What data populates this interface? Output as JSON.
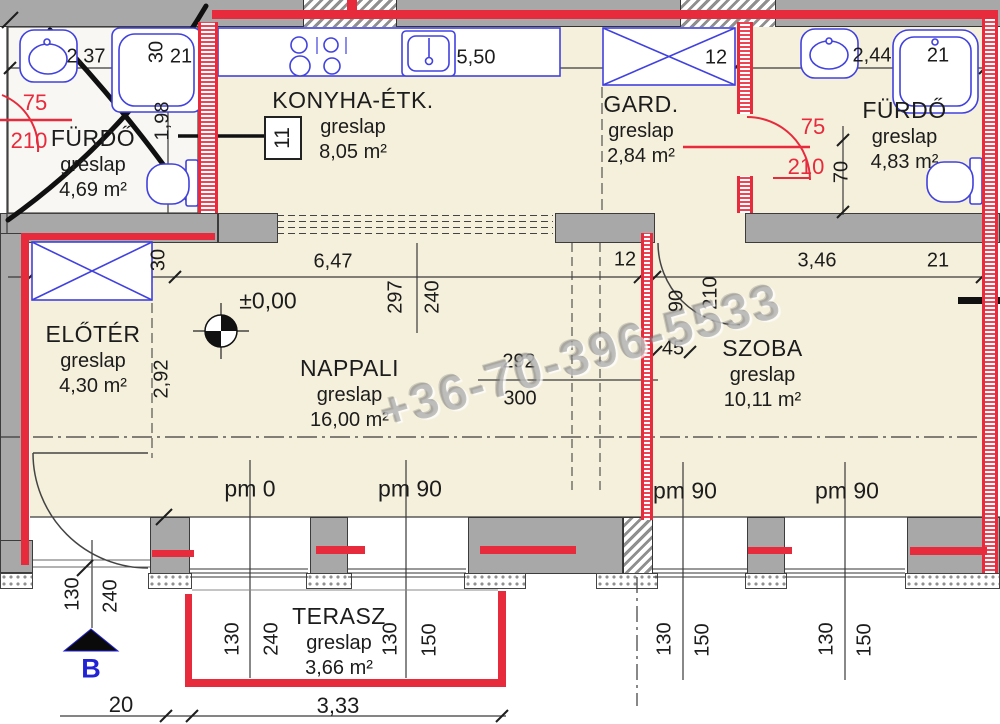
{
  "meta": {
    "watermark": "+36-70-396-5533",
    "room_tag": "11"
  },
  "colors": {
    "wall_gray": "#a8a8a8",
    "floor_cream": "#f5f0dc",
    "overlay_red": "#e72a3c",
    "fixture_blue": "#4141e0",
    "watermark_gray": "#7d7d7d",
    "section_blue": "#2323d6"
  },
  "rooms": {
    "furdo_left": {
      "name": "FÜRDŐ",
      "finish": "greslap",
      "area": "4,69 m²"
    },
    "konyha": {
      "name": "KONYHA-ÉTK.",
      "finish": "greslap",
      "area": "8,05 m²"
    },
    "gard": {
      "name": "GARD.",
      "finish": "greslap",
      "area": "2,84 m²"
    },
    "furdo_right": {
      "name": "FÜRDŐ",
      "finish": "greslap",
      "area": "4,83 m²"
    },
    "eloter": {
      "name": "ELŐTÉR",
      "finish": "greslap",
      "area": "4,30 m²"
    },
    "nappali": {
      "name": "NAPPALI",
      "finish": "greslap",
      "area": "16,00 m²"
    },
    "szoba": {
      "name": "SZOBA",
      "finish": "greslap",
      "area": "10,11 m²"
    },
    "terasz": {
      "name": "TERASZ",
      "finish": "greslap",
      "area": "3,66 m²"
    }
  },
  "doors": [
    {
      "id": "furdo-left-door",
      "width": "75",
      "height": "210"
    },
    {
      "id": "furdo-right-door",
      "width": "75",
      "height": "210"
    },
    {
      "id": "szoba-door",
      "width": "90",
      "height": "210"
    }
  ],
  "labels": [
    {
      "id": "dim-bath-left-width",
      "text": "2,37",
      "x": 86,
      "y": 57
    },
    {
      "id": "dim-wall-30-top",
      "text": "30",
      "x": 157,
      "y": 52,
      "rot": 1
    },
    {
      "id": "dim-21-top-left",
      "text": "21",
      "x": 181,
      "y": 57
    },
    {
      "id": "dim-kitchen-width",
      "text": "5,50",
      "x": 476,
      "y": 58
    },
    {
      "id": "dim-gard-wall-12",
      "text": "12",
      "x": 716,
      "y": 58
    },
    {
      "id": "dim-bath-right-width",
      "text": "2,44",
      "x": 872,
      "y": 56
    },
    {
      "id": "dim-21-top-right",
      "text": "21",
      "x": 938,
      "y": 56
    },
    {
      "id": "dim-bath-left-198",
      "text": "1,98",
      "x": 163,
      "y": 121,
      "rot": 1
    },
    {
      "id": "dim-eloter-30",
      "text": "30",
      "x": 159,
      "y": 260,
      "rot": 1
    },
    {
      "id": "dim-nappali-width",
      "text": "6,47",
      "x": 333,
      "y": 262
    },
    {
      "id": "dim-wall-12-mid",
      "text": "12",
      "x": 625,
      "y": 260
    },
    {
      "id": "dim-szoba-width",
      "text": "3,46",
      "x": 817,
      "y": 261
    },
    {
      "id": "dim-21-right",
      "text": "21",
      "x": 938,
      "y": 261
    },
    {
      "id": "dim-297",
      "text": "297",
      "x": 396,
      "y": 297,
      "rot": 1
    },
    {
      "id": "dim-240-nappali",
      "text": "240",
      "x": 433,
      "y": 297,
      "rot": 1
    },
    {
      "id": "dim-eloter-depth",
      "text": "2,92",
      "x": 162,
      "y": 379,
      "rot": 1
    },
    {
      "id": "dim-292",
      "text": "292",
      "x": 519,
      "y": 362
    },
    {
      "id": "dim-300",
      "text": "300",
      "x": 520,
      "y": 399
    },
    {
      "id": "dim-szoba-door-90",
      "text": "90",
      "x": 677,
      "y": 301,
      "rot": 1
    },
    {
      "id": "dim-szoba-door-210",
      "text": "210",
      "x": 711,
      "y": 293,
      "rot": 1
    },
    {
      "id": "dim-45",
      "text": "45",
      "x": 673,
      "y": 349
    },
    {
      "id": "dim-70",
      "text": "70",
      "x": 842,
      "y": 172,
      "rot": 1
    },
    {
      "id": "door-left-width",
      "text": "75",
      "x": 35,
      "y": 103,
      "color": "red",
      "fs": 22
    },
    {
      "id": "door-left-height",
      "text": "210",
      "x": 29,
      "y": 141,
      "color": "red",
      "fs": 22
    },
    {
      "id": "door-right-width",
      "text": "75",
      "x": 813,
      "y": 127,
      "color": "red",
      "fs": 22
    },
    {
      "id": "door-right-height",
      "text": "210",
      "x": 806,
      "y": 167,
      "color": "red",
      "fs": 22
    },
    {
      "id": "parapet-pm0",
      "text": "pm 0",
      "x": 250,
      "y": 489,
      "fs": 23
    },
    {
      "id": "parapet-pm90-1",
      "text": "pm 90",
      "x": 410,
      "y": 489,
      "fs": 23
    },
    {
      "id": "parapet-pm90-2",
      "text": "pm 90",
      "x": 685,
      "y": 491,
      "fs": 23
    },
    {
      "id": "parapet-pm90-3",
      "text": "pm 90",
      "x": 847,
      "y": 491,
      "fs": 23
    },
    {
      "id": "level-mark",
      "text": "±0,00",
      "x": 268,
      "y": 301,
      "fs": 23
    },
    {
      "id": "dim-130-left",
      "text": "130",
      "x": 73,
      "y": 594,
      "rot": 1
    },
    {
      "id": "dim-240-left",
      "text": "240",
      "x": 111,
      "y": 596,
      "rot": 1
    },
    {
      "id": "dim-terasz-130a",
      "text": "130",
      "x": 233,
      "y": 639,
      "rot": 1
    },
    {
      "id": "dim-terasz-240",
      "text": "240",
      "x": 272,
      "y": 639,
      "rot": 1
    },
    {
      "id": "dim-terasz-130b",
      "text": "130",
      "x": 391,
      "y": 639,
      "rot": 1
    },
    {
      "id": "dim-terasz-150",
      "text": "150",
      "x": 430,
      "y": 640,
      "rot": 1
    },
    {
      "id": "dim-right-130a",
      "text": "130",
      "x": 665,
      "y": 639,
      "rot": 1
    },
    {
      "id": "dim-right-150a",
      "text": "150",
      "x": 703,
      "y": 640,
      "rot": 1
    },
    {
      "id": "dim-right-130b",
      "text": "130",
      "x": 827,
      "y": 639,
      "rot": 1
    },
    {
      "id": "dim-right-150b",
      "text": "150",
      "x": 865,
      "y": 640,
      "rot": 1
    },
    {
      "id": "dim-20",
      "text": "20",
      "x": 121,
      "y": 705,
      "fs": 22
    },
    {
      "id": "dim-terasz-width",
      "text": "3,33",
      "x": 338,
      "y": 706,
      "fs": 22
    },
    {
      "id": "section-label-b",
      "text": "B",
      "x": 91,
      "y": 669,
      "color": "blue",
      "fs": 27
    }
  ]
}
